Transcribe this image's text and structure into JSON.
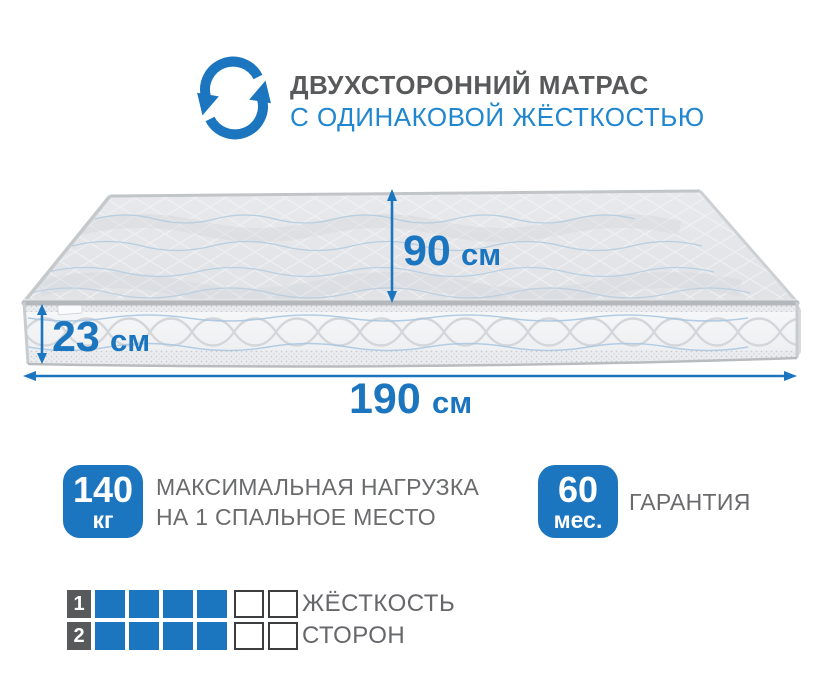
{
  "header": {
    "icon": "rotate-arrows-icon",
    "title": "ДВУХСТОРОННИЙ МАТРАС",
    "subtitle": "С ОДИНАКОВОЙ ЖЁСТКОСТЬЮ"
  },
  "mattress": {
    "dimensions": {
      "depth": {
        "value": "90",
        "unit": "см"
      },
      "height": {
        "value": "23",
        "unit": "см"
      },
      "length": {
        "value": "190",
        "unit": "см"
      }
    }
  },
  "features": {
    "max_load": {
      "badge_value": "140",
      "badge_unit": "кг",
      "label_line1": "МАКСИМАЛЬНАЯ НАГРУЗКА",
      "label_line2": "НА 1 СПАЛЬНОЕ МЕСТО"
    },
    "warranty": {
      "badge_value": "60",
      "badge_unit": "мес.",
      "label": "ГАРАНТИЯ"
    }
  },
  "firmness": {
    "label_line1": "ЖЁСТКОСТЬ",
    "label_line2": "СТОРОН",
    "rows": [
      {
        "side": "1",
        "filled": 4,
        "total": 6
      },
      {
        "side": "2",
        "filled": 4,
        "total": 6
      }
    ]
  },
  "colors": {
    "accent_blue": "#1c76bf",
    "subtitle_blue": "#1f86cf",
    "title_gray": "#58595b",
    "text_gray": "#6a6b6d",
    "number_square_gray": "#58595b",
    "empty_border": "#3b3d3f"
  }
}
